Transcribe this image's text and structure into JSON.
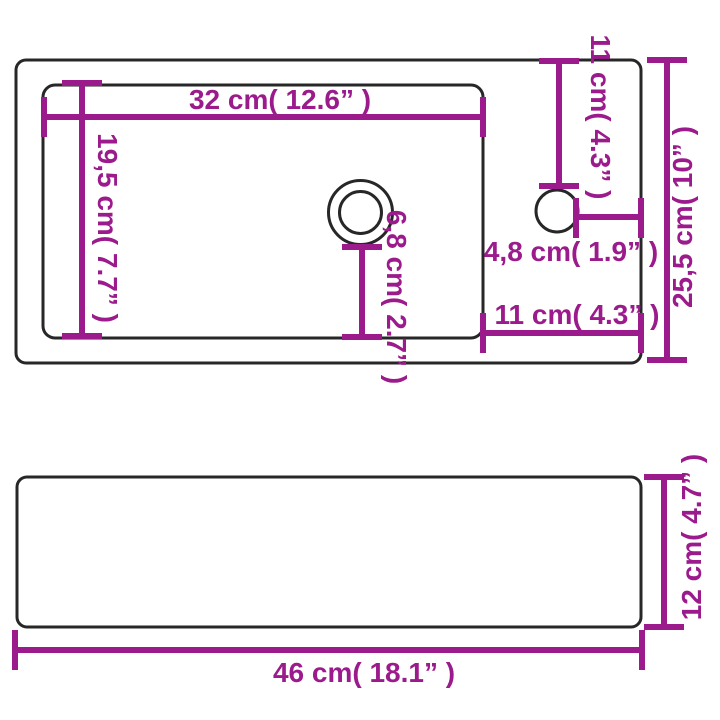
{
  "colors": {
    "dimension": "#9B1B8C",
    "outline": "#272727",
    "background": "#FFFFFF"
  },
  "labels": {
    "basin_width": "32 cm( 12.6” )",
    "basin_depth": "19,5 cm( 7.7” )",
    "faucet_top_offset": "11 cm( 4.3” )",
    "faucet_side_offset": "4,8 cm( 1.9” )",
    "basin_right_gap": "11 cm( 4.3” )",
    "total_depth": "25,5 cm( 10” )",
    "drain_offset": "6,8 cm( 2.7” )",
    "total_width": "46 cm( 18.1” )",
    "total_height": "12 cm( 4.7” )"
  }
}
